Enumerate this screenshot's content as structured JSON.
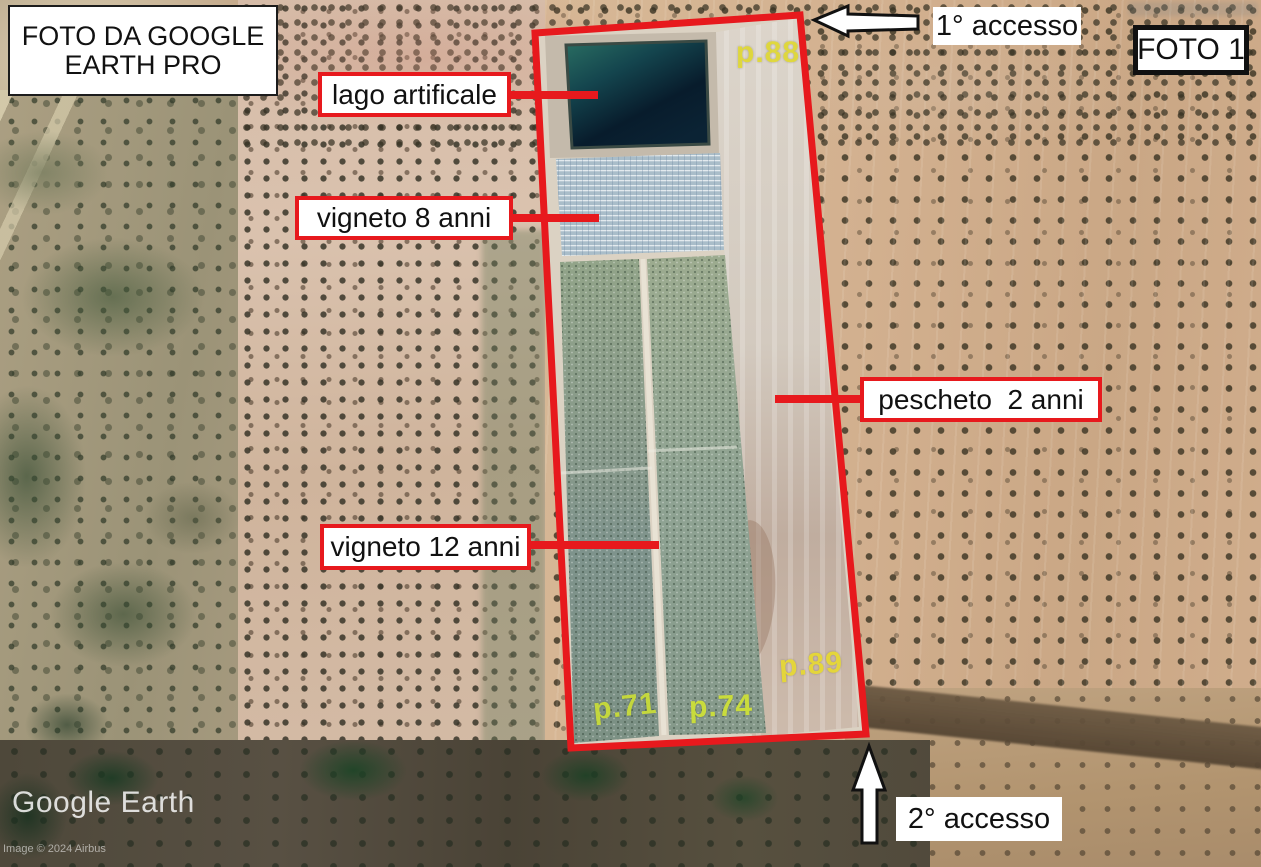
{
  "header": {
    "source_box": {
      "line1": "FOTO DA GOOGLE",
      "line2": "EARTH PRO"
    },
    "photo_tag": "FOTO 1"
  },
  "callouts": {
    "lake": "lago artificale",
    "vineyard8": "vigneto 8 anni",
    "vineyard12": "vigneto 12 anni",
    "peach": "pescheto  2 anni"
  },
  "access": {
    "first": "1° accesso",
    "second": "2° accesso"
  },
  "parcels": {
    "p88": "p.88",
    "p89": "p.89",
    "p71": "p.71",
    "p74": "p.74"
  },
  "watermark": {
    "brand": "Google Earth",
    "credit": "Image © 2024 Airbus"
  },
  "colors": {
    "annotation_red": "#e7191d",
    "parcel_yellow": "#e5dd30",
    "lake_dark": "#0b2334",
    "vineyard8_blue": "#a9bdc9",
    "vineyard_green": "#87998b",
    "peach_strip": "#d3cabf"
  }
}
